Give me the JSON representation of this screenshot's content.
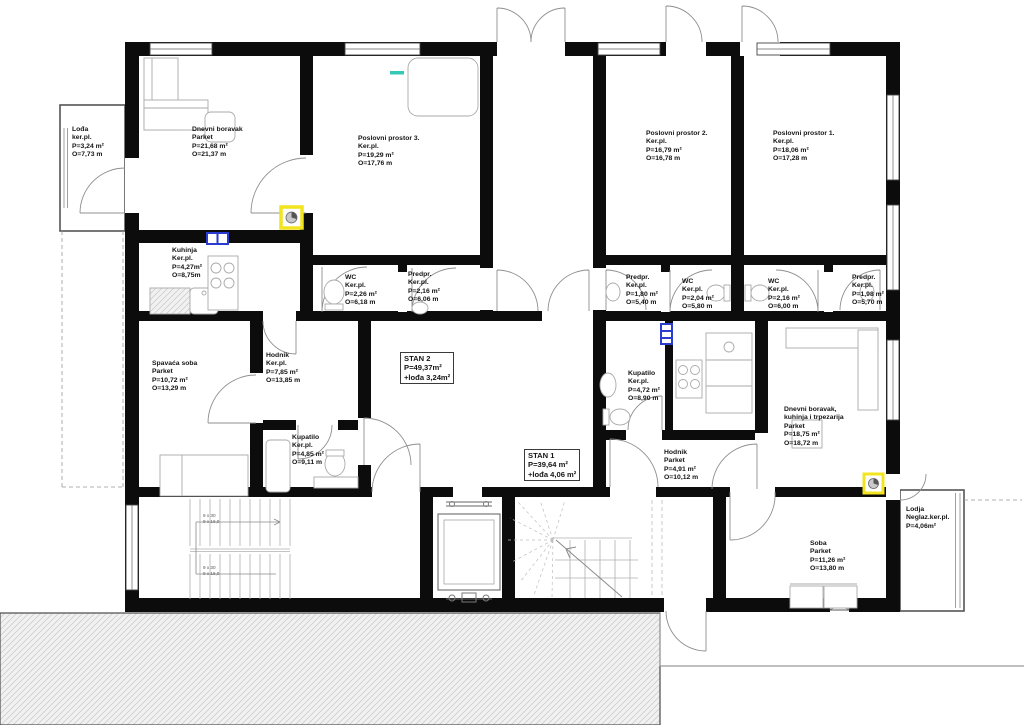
{
  "plan": {
    "title": "Floor plan – apartments and business premises",
    "colors": {
      "wall": "#0c0c0c",
      "thin_line": "#9a9a9a",
      "highlight_yellow": "#f2e41f",
      "highlight_blue": "#2a3bd0",
      "teal_mark": "#35c7b7",
      "hatch_bg": "#f1f1f1"
    },
    "rooms": [
      {
        "id": "lodza-left",
        "x": 72,
        "y": 126,
        "lines": [
          "Lođa",
          "ker.pl.",
          "P=3,24 m²",
          "O=7,73 m"
        ]
      },
      {
        "id": "dnevni-boravak-left",
        "x": 192,
        "y": 126,
        "lines": [
          "Dnevni boravak",
          "Parket",
          "P=21,68 m²",
          "O=21,37 m"
        ]
      },
      {
        "id": "poslovni-prostor-3",
        "x": 358,
        "y": 135,
        "lines": [
          "Poslovni prostor 3.",
          "Ker.pl.",
          "P=19,29 m²",
          "O=17,76 m"
        ]
      },
      {
        "id": "poslovni-prostor-2",
        "x": 646,
        "y": 130,
        "lines": [
          "Poslovni prostor 2.",
          "Ker.pl.",
          "P=16,79 m²",
          "O=16,78 m"
        ]
      },
      {
        "id": "poslovni-prostor-1",
        "x": 773,
        "y": 130,
        "lines": [
          "Poslovni prostor 1.",
          "Ker.pl.",
          "P=18,06 m²",
          "O=17,28 m"
        ]
      },
      {
        "id": "kuhinja",
        "x": 172,
        "y": 247,
        "lines": [
          "Kuhinja",
          "Ker.pl.",
          "P=4,27m²",
          "O=8,75m"
        ]
      },
      {
        "id": "wc-left",
        "x": 345,
        "y": 274,
        "lines": [
          "WC",
          "Ker.pl.",
          "P=2,26 m²",
          "O=6,18 m"
        ]
      },
      {
        "id": "predpr-left",
        "x": 408,
        "y": 271,
        "lines": [
          "Predpr.",
          "Ker.pl.",
          "P=2,16 m²",
          "O=6,06 m"
        ]
      },
      {
        "id": "predpr-right-1",
        "x": 626,
        "y": 274,
        "lines": [
          "Predpr.",
          "Ker.pl.",
          "P=1,80 m²",
          "O=5,40 m"
        ]
      },
      {
        "id": "wc-right-1",
        "x": 682,
        "y": 278,
        "lines": [
          "WC",
          "Ker.pl.",
          "P=2,04 m²",
          "O=5,80 m"
        ]
      },
      {
        "id": "wc-right-2",
        "x": 768,
        "y": 278,
        "lines": [
          "WC",
          "Ker.pl.",
          "P=2,16 m²",
          "O=6,00 m"
        ]
      },
      {
        "id": "predpr-right-2",
        "x": 852,
        "y": 274,
        "lines": [
          "Predpr.",
          "Ker.pl.",
          "P=1,98 m²",
          "O=5,70 m"
        ]
      },
      {
        "id": "spavaca-soba",
        "x": 152,
        "y": 360,
        "lines": [
          "Spavaća soba",
          "Parket",
          "P=10,72 m²",
          "O=13,29 m"
        ]
      },
      {
        "id": "hodnik-stan2",
        "x": 266,
        "y": 352,
        "lines": [
          "Hodnik",
          "Ker.pl.",
          "P=7,85 m²",
          "O=13,85 m"
        ]
      },
      {
        "id": "stan-2",
        "x": 400,
        "y": 352,
        "boxed": true,
        "lines": [
          "STAN 2",
          "P=49,37m²",
          "+lođa 3,24m²"
        ]
      },
      {
        "id": "kupatilo-stan2",
        "x": 292,
        "y": 434,
        "lines": [
          "Kupatilo",
          "Ker.pl.",
          "P=4,85 m²",
          "O=9,11 m"
        ]
      },
      {
        "id": "kupatilo-stan1",
        "x": 628,
        "y": 370,
        "lines": [
          "Kupatilo",
          "Ker.pl.",
          "P=4,72 m²",
          "O=8,90 m"
        ]
      },
      {
        "id": "stan-1",
        "x": 524,
        "y": 449,
        "boxed": true,
        "lines": [
          "STAN 1",
          "P=39,64 m²",
          "+lođa 4,06 m²"
        ]
      },
      {
        "id": "hodnik-stan1",
        "x": 664,
        "y": 449,
        "lines": [
          "Hodnik",
          "Parket",
          "P=4,91 m²",
          "O=10,12 m"
        ]
      },
      {
        "id": "dnevni-boravak-desni",
        "x": 784,
        "y": 406,
        "lines": [
          "Dnevni boravak,",
          "kuhinja i trpezarija",
          "Parket",
          "P=18,75 m²",
          "O=18,72 m"
        ]
      },
      {
        "id": "soba",
        "x": 810,
        "y": 540,
        "lines": [
          "Soba",
          "Parket",
          "P=11,26 m²",
          "O=13,80 m"
        ]
      },
      {
        "id": "lodja-right",
        "x": 906,
        "y": 506,
        "lines": [
          "Lodja",
          "Neglaz.ker.pl.",
          "P=4,06m²"
        ]
      }
    ],
    "stair_notes": [
      {
        "id": "stair-run-upper",
        "x": 203,
        "y": 513,
        "lines": [
          "9 x 30",
          "9 x 16,0"
        ]
      },
      {
        "id": "stair-run-lower",
        "x": 203,
        "y": 565,
        "lines": [
          "9 x 30",
          "9 x 16,0"
        ]
      }
    ]
  }
}
